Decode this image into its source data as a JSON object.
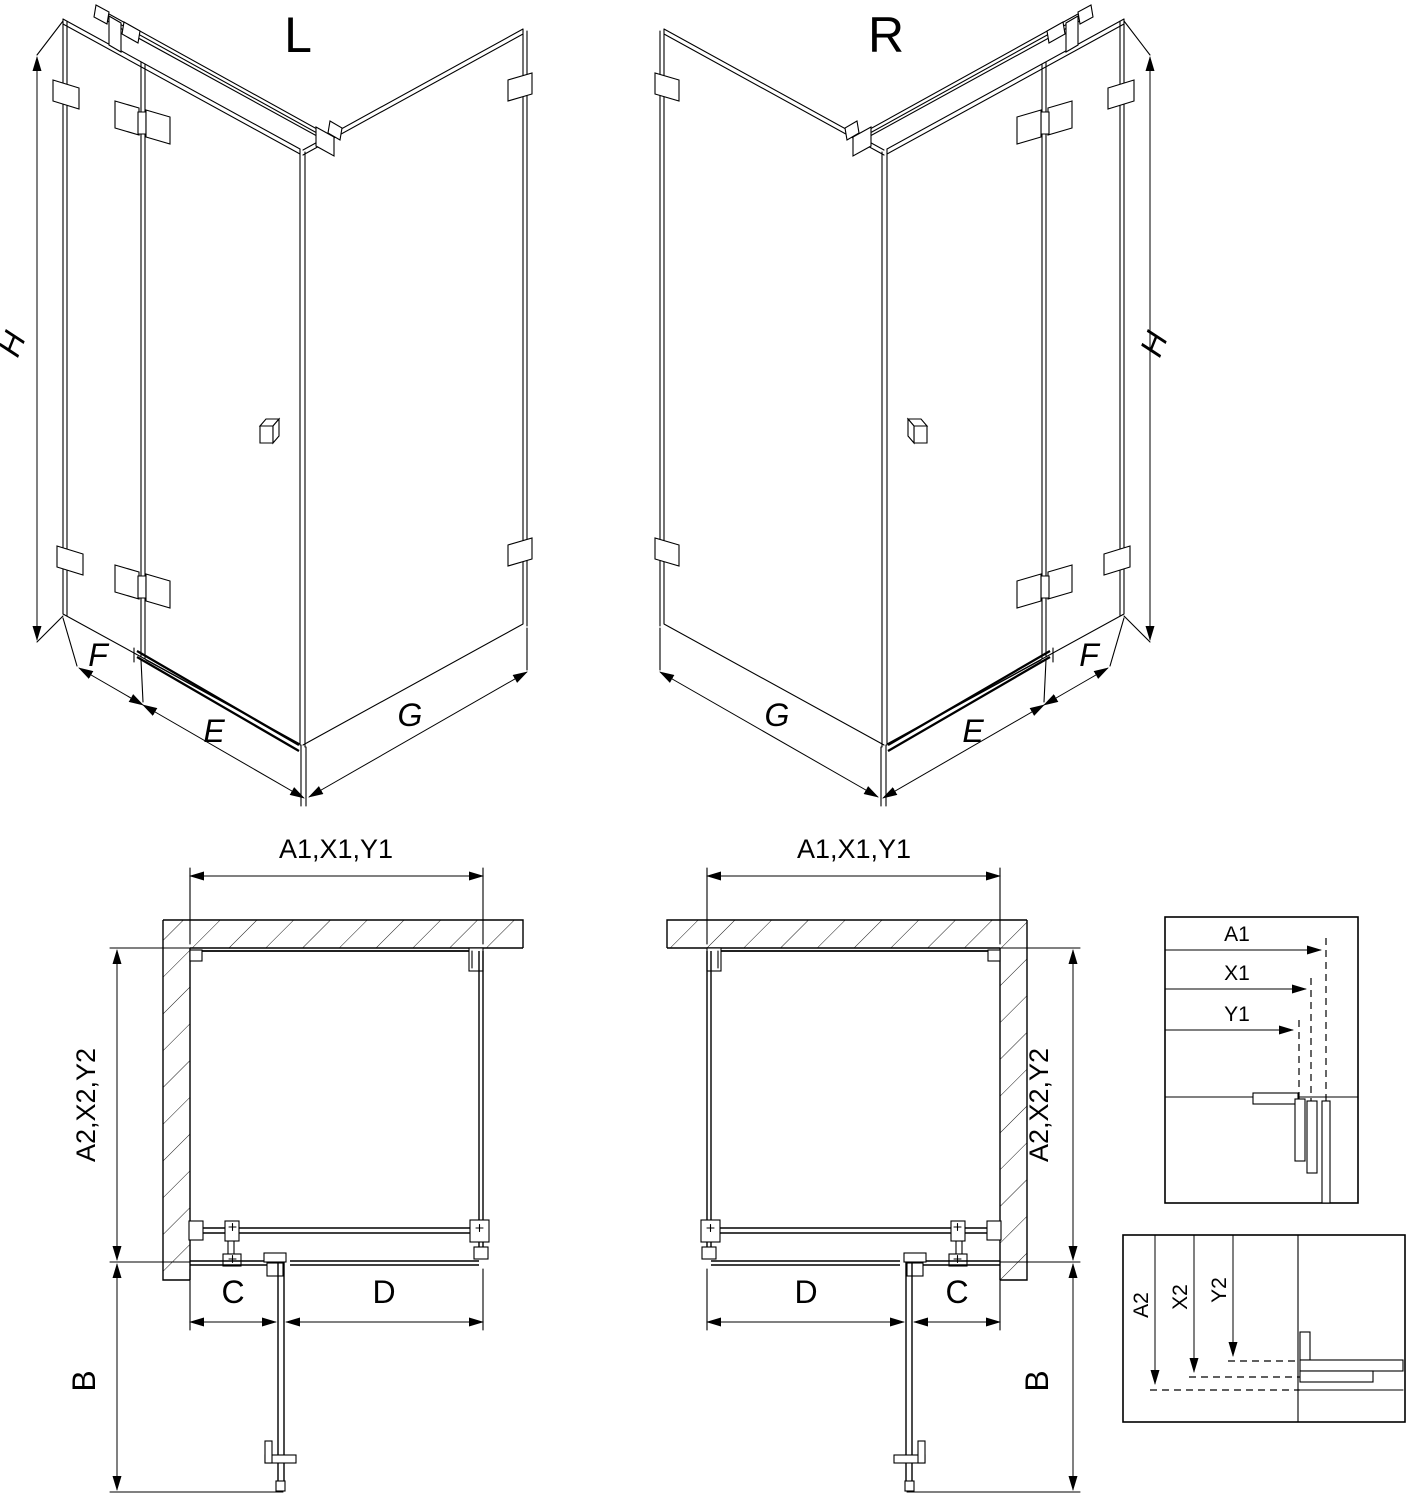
{
  "drawing": {
    "variant_left": {
      "title": "L"
    },
    "variant_right": {
      "title": "R"
    },
    "iso_dimensions": {
      "height": "H",
      "return_panel": "F",
      "door": "E",
      "side_wall": "G"
    },
    "plan_dimensions": {
      "width_top": "A1,X1,Y1",
      "depth_side": "A2,X2,Y2",
      "fixed_inline": "C",
      "door_width": "D",
      "door_opening": "B"
    },
    "detail_top": {
      "labels": [
        "A1",
        "X1",
        "Y1"
      ]
    },
    "detail_bottom": {
      "labels": [
        "A2",
        "X2",
        "Y2"
      ]
    },
    "colors": {
      "line": "#000000",
      "background": "#ffffff"
    }
  }
}
